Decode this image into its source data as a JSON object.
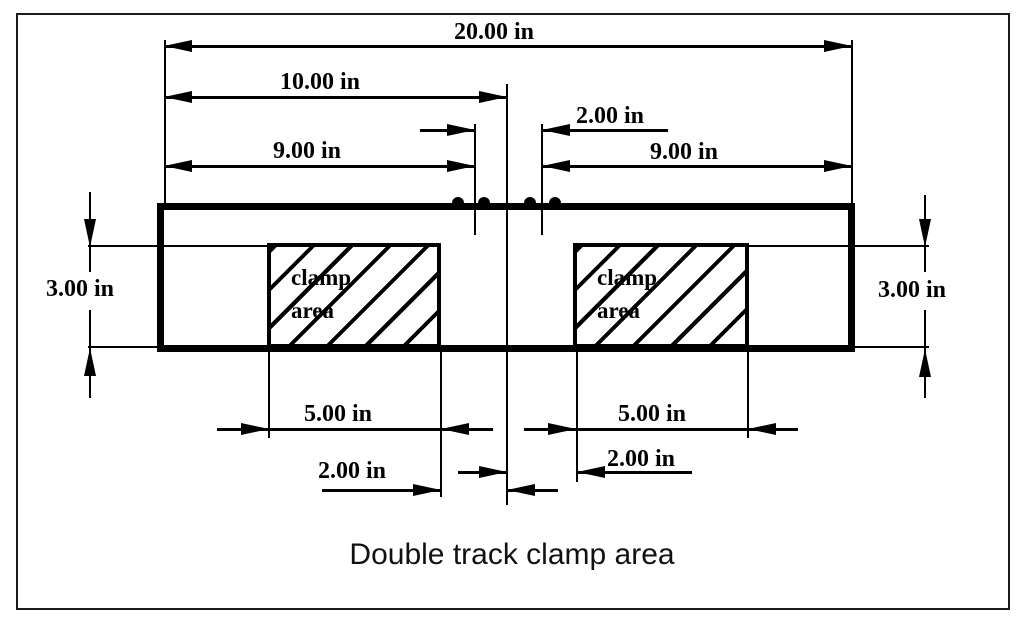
{
  "diagram": {
    "title": "Double track clamp area",
    "dimensions": {
      "overall_width": "20.00 in",
      "center_to_end": "10.00 in",
      "center_gap": "2.00 in",
      "left_span": "9.00 in",
      "right_span": "9.00 in",
      "left_height": "3.00 in",
      "right_height": "3.00 in",
      "left_clamp_width": "5.00 in",
      "right_clamp_width": "5.00 in",
      "left_clamp_offset": "2.00 in",
      "right_clamp_offset": "2.00 in"
    },
    "clamp_label": {
      "line1": "clamp",
      "line2": "area"
    },
    "colors": {
      "ink": "#000000",
      "paper": "#ffffff"
    }
  }
}
